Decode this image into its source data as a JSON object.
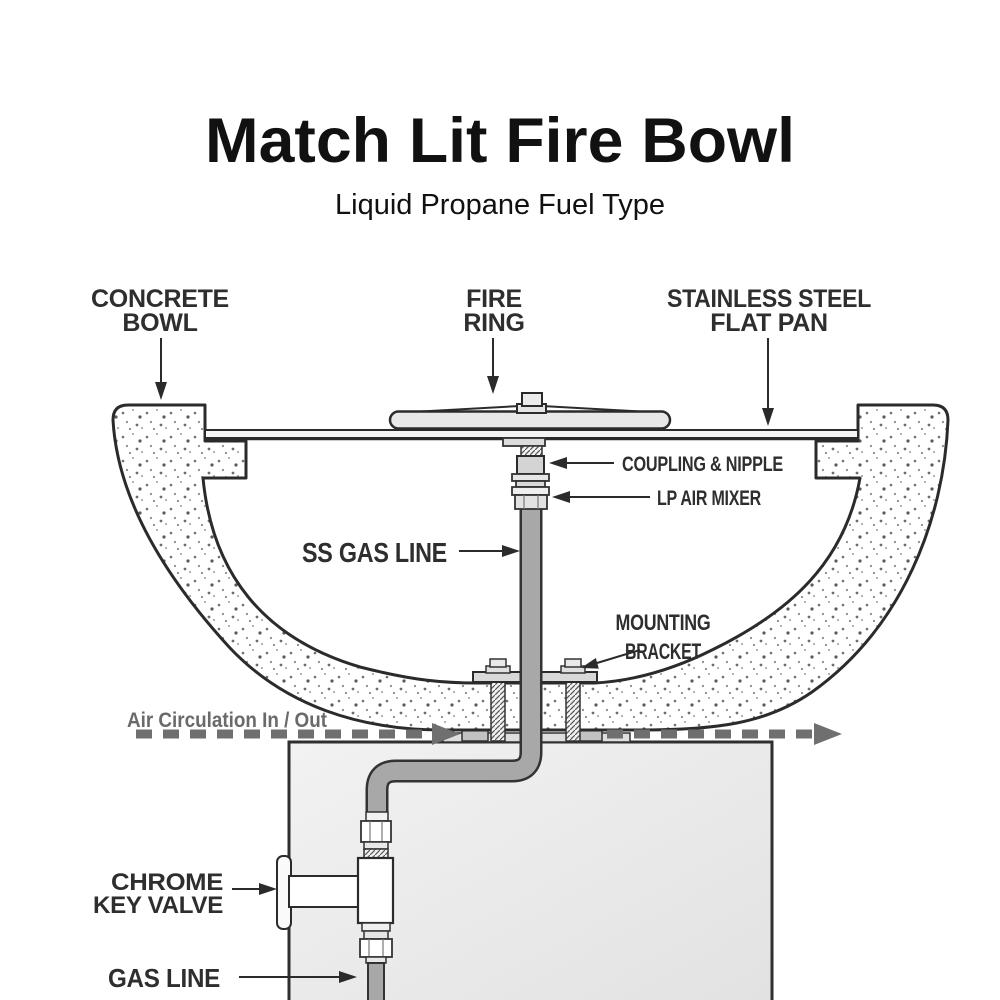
{
  "title": "Match Lit Fire Bowl",
  "subtitle": "Liquid Propane Fuel Type",
  "labels": {
    "concrete_bowl": {
      "line1": "CONCRETE",
      "line2": "BOWL"
    },
    "fire_ring": {
      "line1": "FIRE",
      "line2": "RING"
    },
    "flat_pan": {
      "line1": "STAINLESS STEEL",
      "line2": "FLAT PAN"
    },
    "coupling_nipple": "COUPLING & NIPPLE",
    "lp_air_mixer": "LP AIR MIXER",
    "ss_gas_line": "SS GAS LINE",
    "mounting_bracket": {
      "line1": "MOUNTING",
      "line2": "BRACKET"
    },
    "air_circulation": "Air Circulation In / Out",
    "chrome_key_valve": {
      "line1": "CHROME",
      "line2": "KEY VALVE"
    },
    "gas_line": "GAS LINE"
  },
  "colors": {
    "outline": "#2b2b2b",
    "label_dark": "#2e2e2e",
    "gas_line_gray": "#a8a8a8",
    "air_flow_gray": "#6f6f6f",
    "fitting_light": "#e8e8e8",
    "coupling_gray": "#d4d4d4",
    "pedestal_gray": "#ececec",
    "pad_gray": "#c2c2c2"
  }
}
